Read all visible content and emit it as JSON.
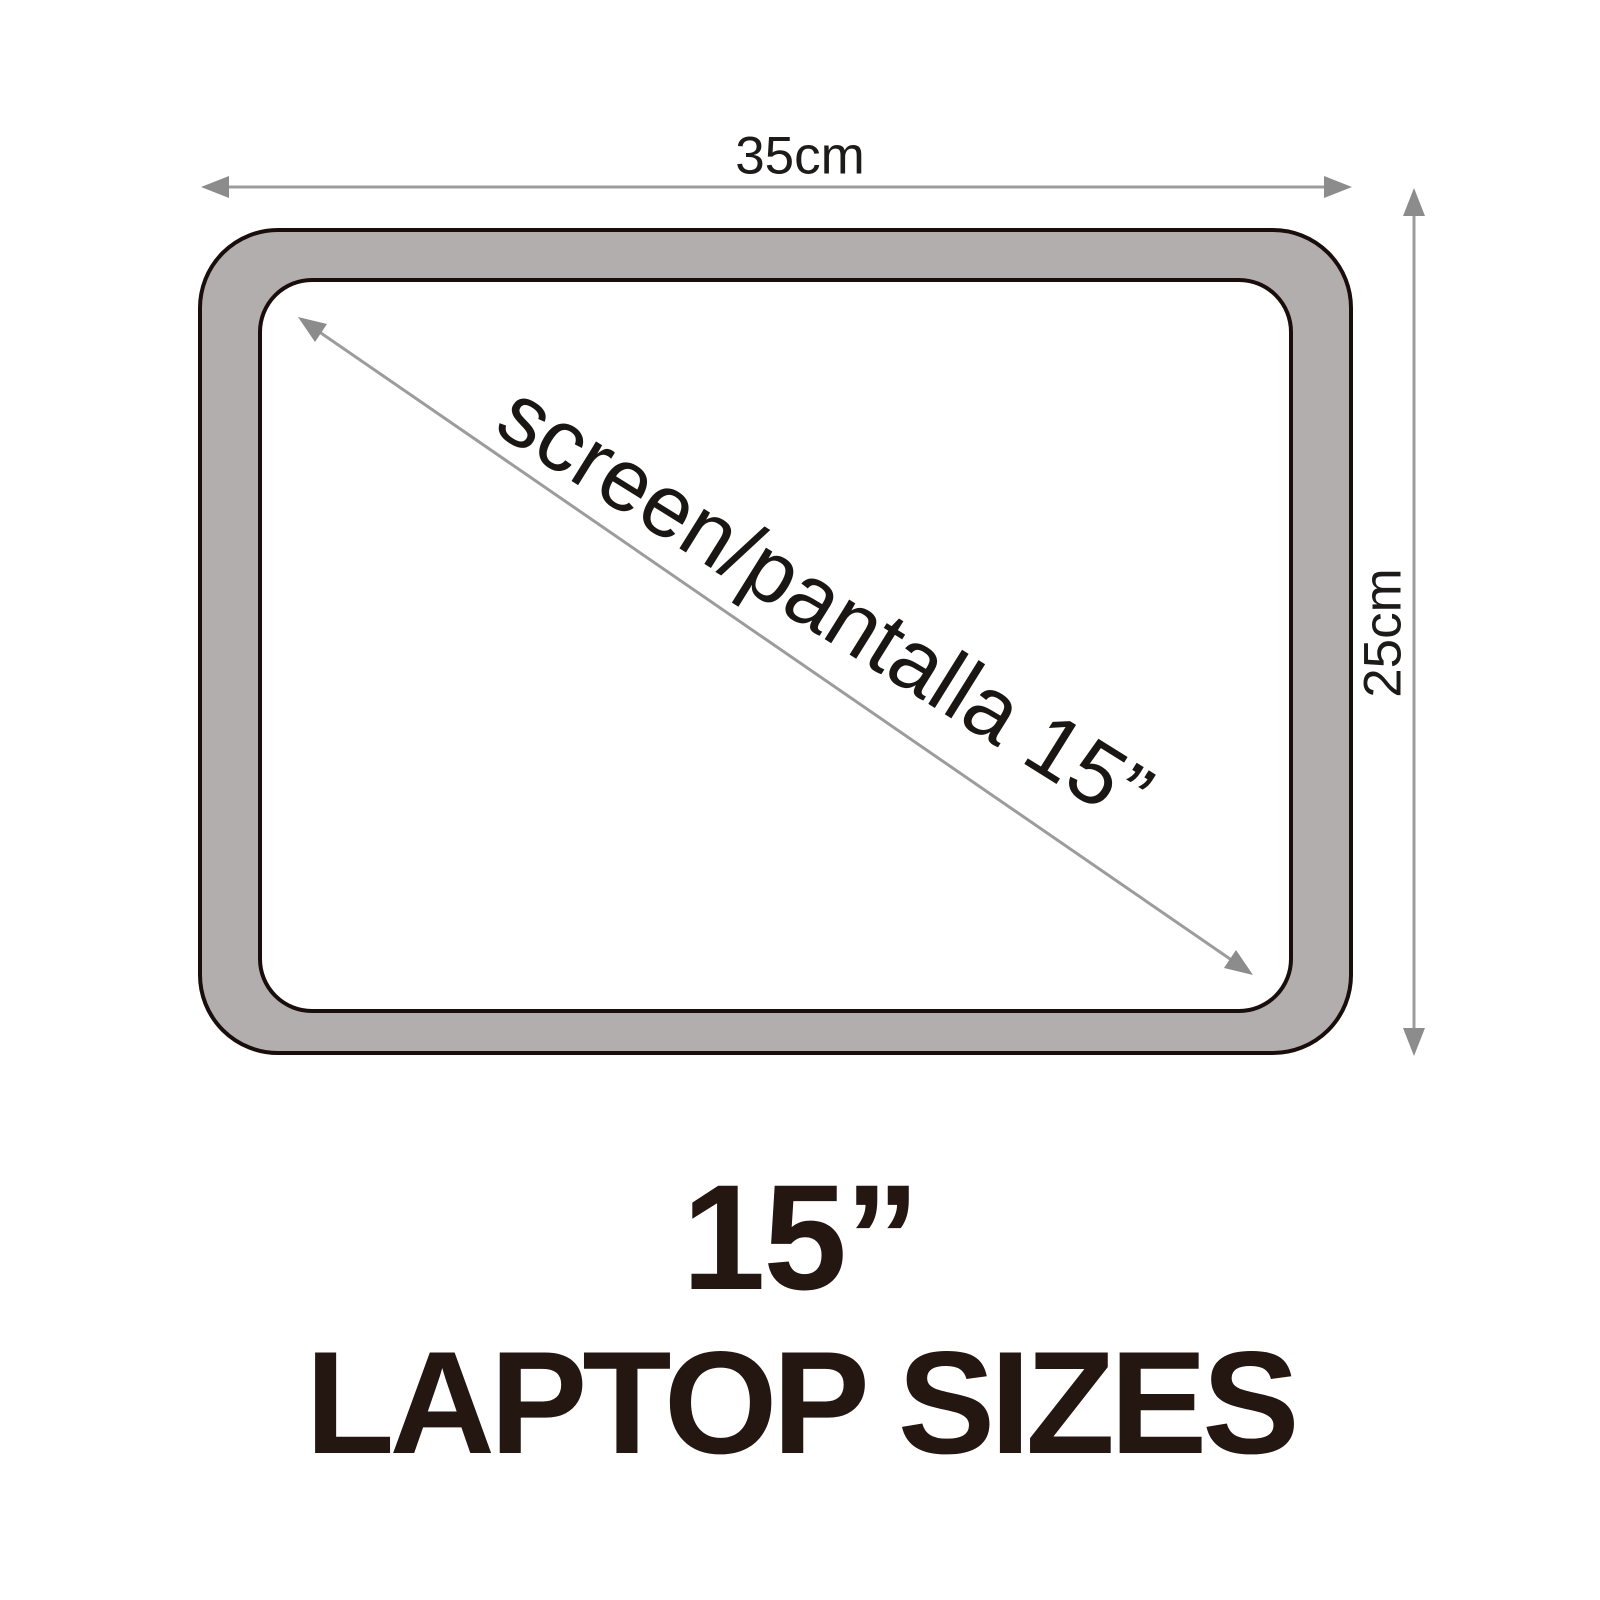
{
  "diagram": {
    "width_label": "35cm",
    "height_label": "25cm",
    "diagonal_label": "screen/pantalla 15”",
    "colors": {
      "frame_fill": "#b3aeae",
      "frame_border": "#190e0c",
      "arrow_line": "#9c9c9c",
      "arrow_head": "#8c8c8c",
      "label_text": "#1d1b1a",
      "title_text": "#241611"
    }
  },
  "title": {
    "line1": "15”",
    "line2": "LAPTOP SIZES"
  }
}
